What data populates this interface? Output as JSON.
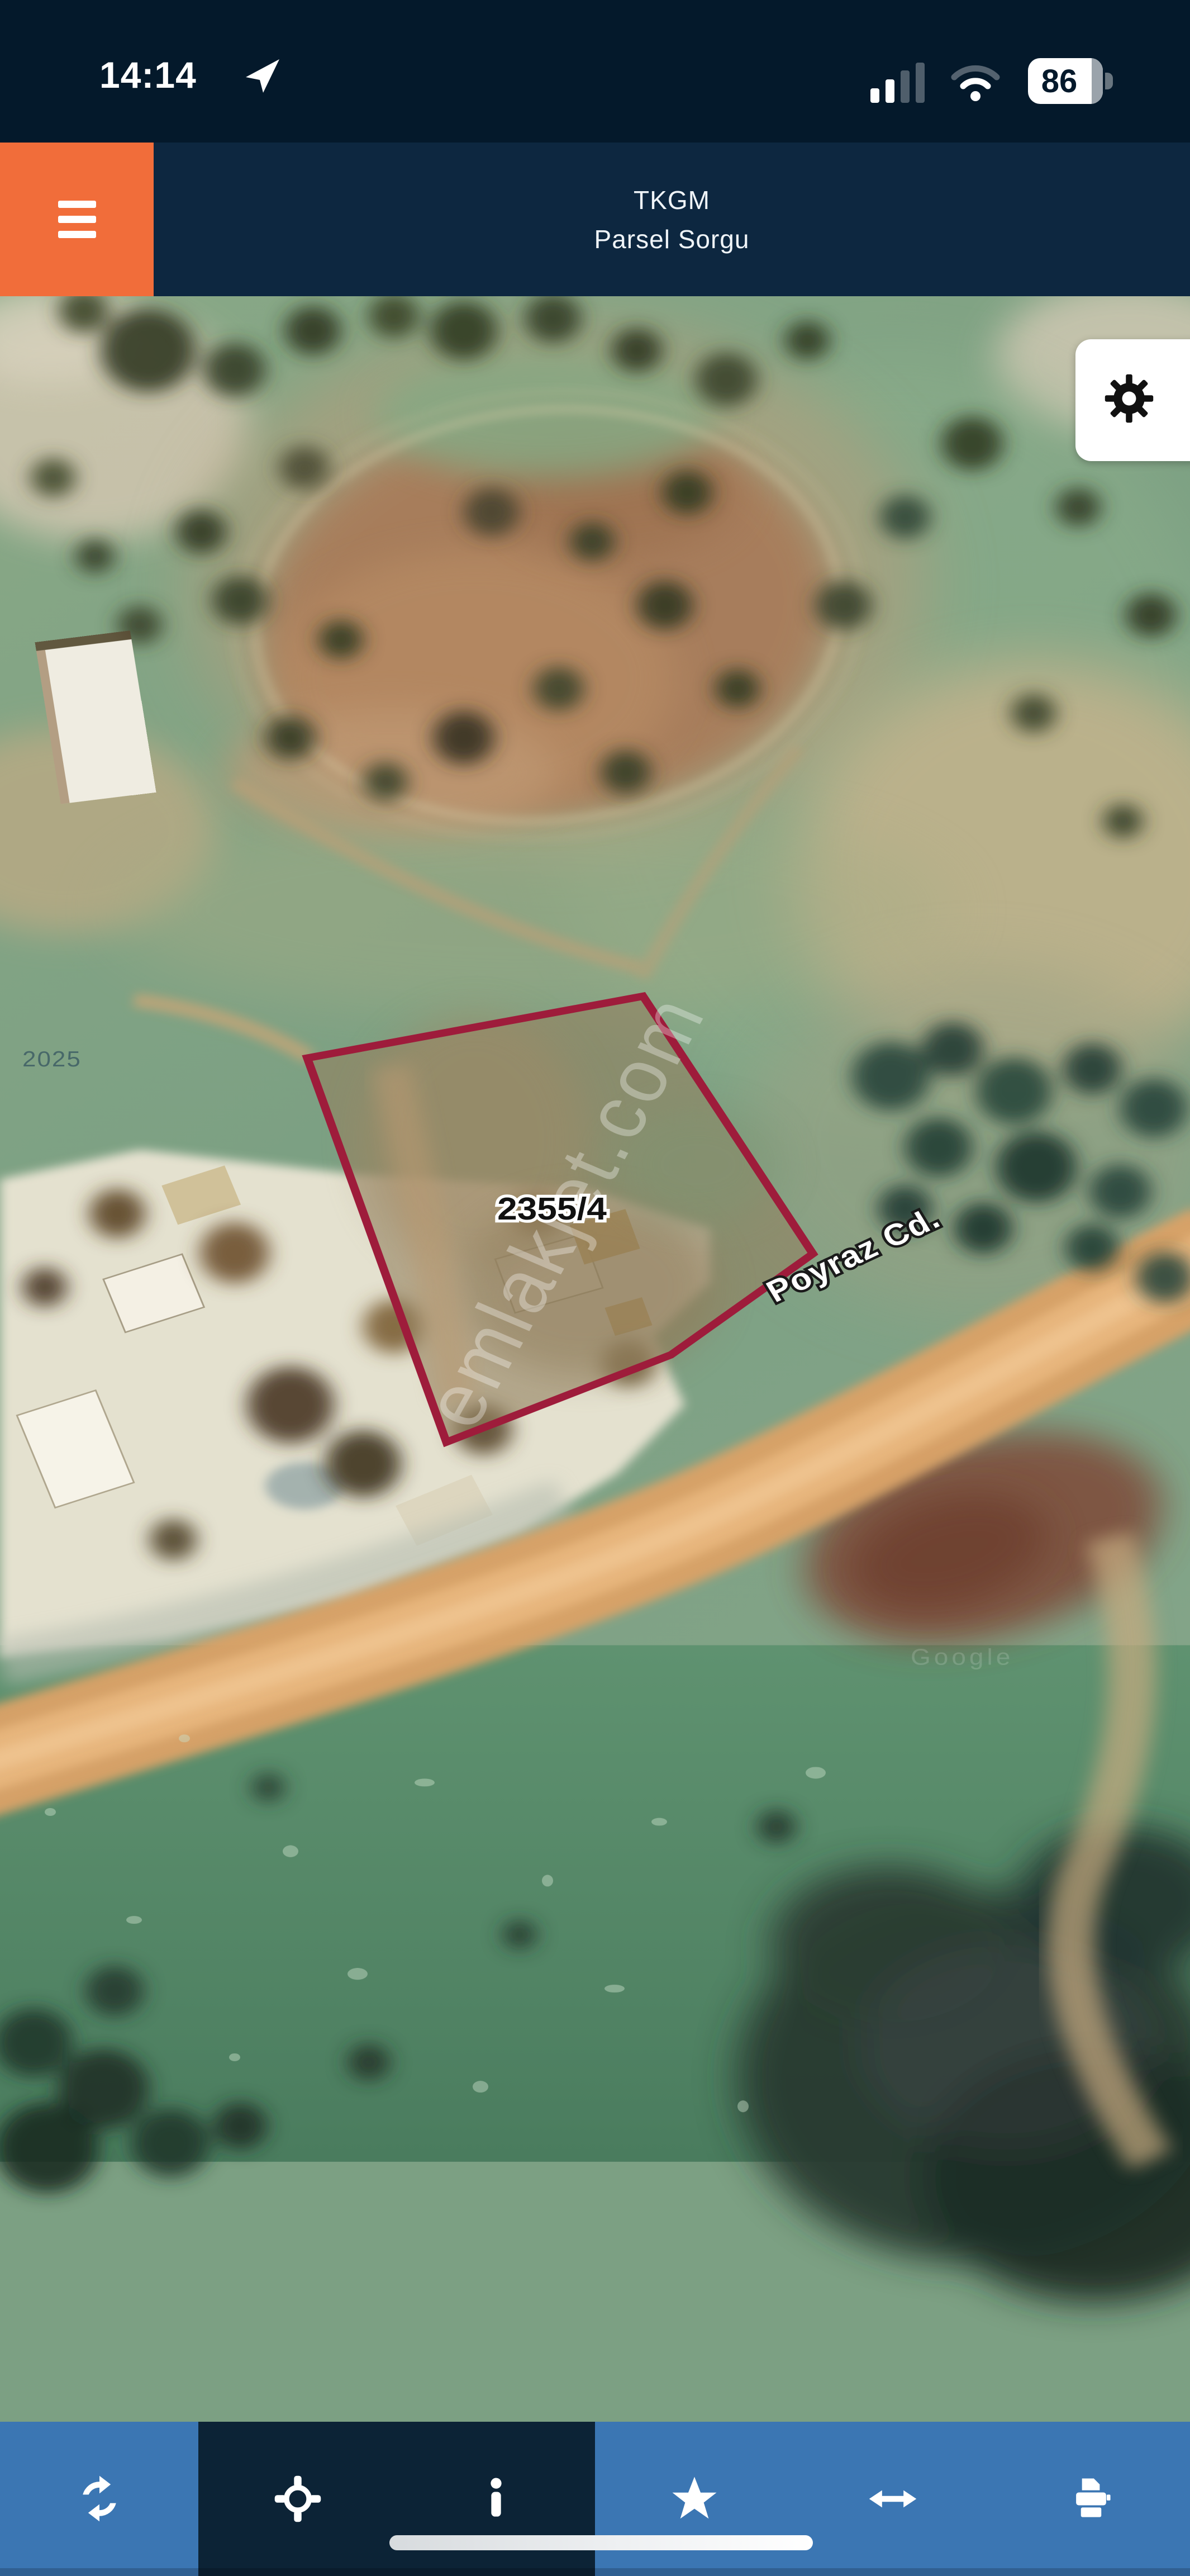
{
  "status_bar": {
    "time": "14:14",
    "battery_percent": "86",
    "icons": [
      "location-arrow-icon",
      "cellular-signal-icon",
      "wifi-icon",
      "battery-icon"
    ]
  },
  "header": {
    "app_title": "TKGM",
    "app_subtitle": "Parsel Sorgu",
    "menu_icon": "hamburger-menu-icon"
  },
  "map": {
    "parcel_label": "2355/4",
    "street_label": "Poyraz Cd.",
    "watermark": "emlakjet.com",
    "attribution_year": "2025",
    "attribution": "Google",
    "settings_icon": "gear-icon",
    "imagery": "satellite"
  },
  "toolbar": {
    "buttons": [
      {
        "icon": "refresh-icon"
      },
      {
        "icon": "crosshair-locate-icon"
      },
      {
        "icon": "info-icon"
      },
      {
        "icon": "star-favorite-icon"
      },
      {
        "icon": "horizontal-arrow-measure-icon"
      },
      {
        "icon": "printer-icon"
      }
    ]
  },
  "colors": {
    "status_bar_bg": "#04192B",
    "header_bg": "#0D2740",
    "accent_orange": "#F16D3A",
    "toolbar_blue": "#3B76B3",
    "toolbar_dark": "#0C2336",
    "parcel_outline_red": "#9E1C3B"
  }
}
